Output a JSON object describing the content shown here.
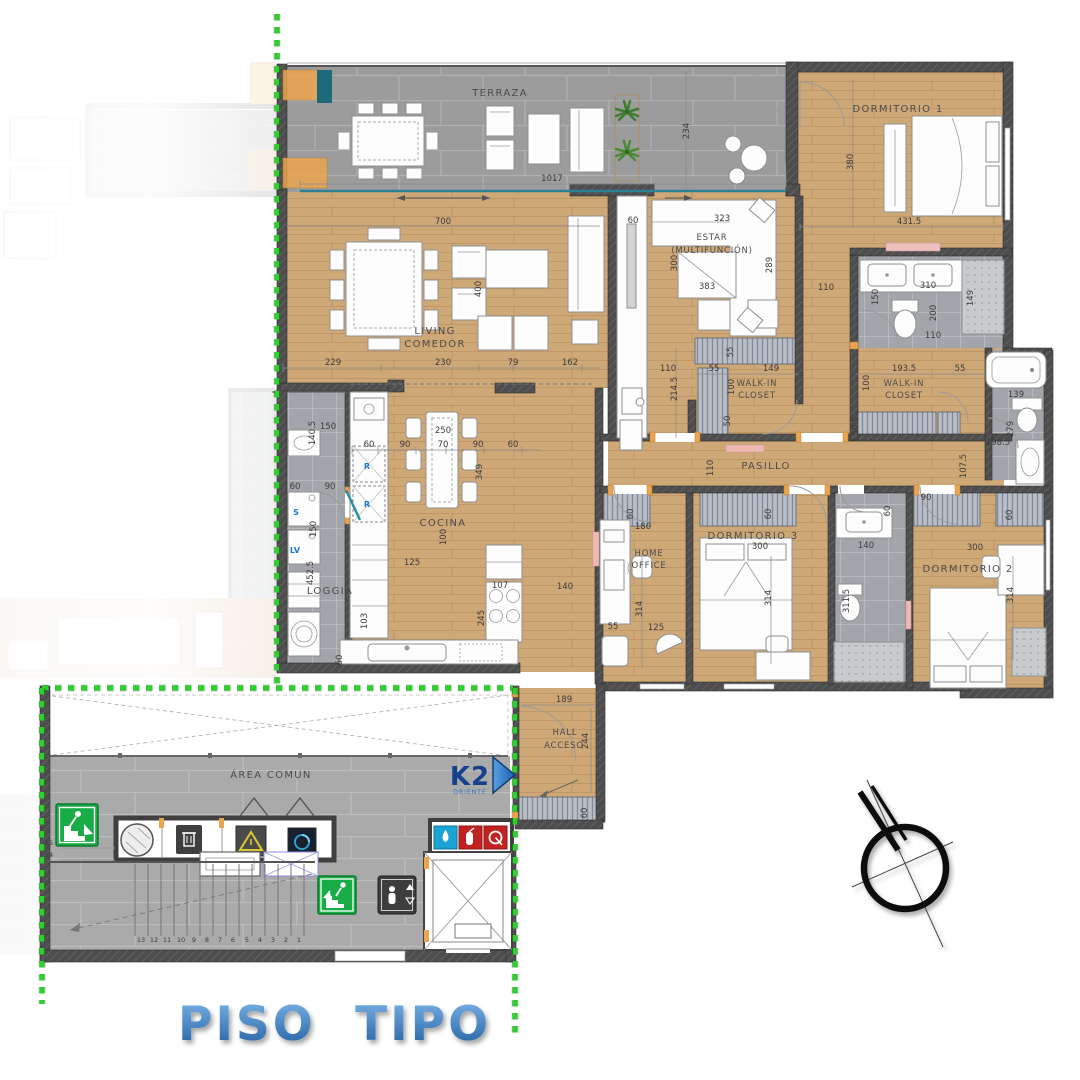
{
  "title": {
    "text": "PISO TIPO",
    "color_top": "#7db5e8",
    "color_bottom": "#1d5c9e"
  },
  "logo": {
    "name": "K2",
    "subtitle": "ORIENTE",
    "text_color": "#17418c",
    "arrow_color": "#2e86d6"
  },
  "rooms": {
    "terraza": "TERRAZA",
    "dormitorio1": "DORMITORIO 1",
    "living_l1": "LIVING",
    "living_l2": "COMEDOR",
    "estar_l1": "ESTAR",
    "estar_l2": "(MULTIFUNCIÓN)",
    "walkin_l1": "WALK-IN",
    "walkin_l2": "CLOSET",
    "pasillo": "PASILLO",
    "cocina": "COCINA",
    "loggia": "LOGGIA",
    "home_l1": "HOME",
    "home_l2": "OFFICE",
    "dormitorio3": "DORMITORIO 3",
    "dormitorio2": "DORMITORIO 2",
    "hall_l1": "HALL",
    "hall_l2": "ACCESO",
    "area_comun": "ÁREA COMUN"
  },
  "dims": {
    "terraza": [
      "1017",
      "234"
    ],
    "dormitorio1": [
      "380",
      "431.5"
    ],
    "living": [
      "700",
      "60",
      "400",
      "229",
      "230",
      "79",
      "162"
    ],
    "estar": [
      "323",
      "300",
      "383",
      "289",
      "110",
      "214.5"
    ],
    "bath1": [
      "110",
      "150",
      "310",
      "200",
      "110",
      "149"
    ],
    "walkin1": [
      "55",
      "55",
      "149",
      "100",
      "50"
    ],
    "walkin2": [
      "193.5",
      "55",
      "100",
      "50.5"
    ],
    "bath2": [
      "139",
      "279",
      "198.5",
      "107.5"
    ],
    "pasillo": [
      "110"
    ],
    "closets": [
      "60",
      "60",
      "60",
      "60",
      "90"
    ],
    "home_office": [
      "180",
      "314",
      "55",
      "125"
    ],
    "dormitorio3": [
      "300",
      "314"
    ],
    "bath3": [
      "140",
      "311.5"
    ],
    "dormitorio2": [
      "300",
      "314"
    ],
    "cocina": [
      "60",
      "90",
      "250",
      "70",
      "90",
      "60",
      "349",
      "100",
      "125",
      "103",
      "107",
      "245",
      "140"
    ],
    "loggia": [
      "140.5",
      "150",
      "60",
      "90",
      "150",
      "452.5",
      "60"
    ],
    "hall": [
      "189",
      "244",
      "60"
    ]
  },
  "appliances": {
    "cocina": [
      "R",
      "R"
    ],
    "loggia": [
      "S",
      "LV"
    ]
  },
  "stairs": {
    "upper": [
      "15",
      "14"
    ],
    "treads": [
      "13",
      "12",
      "11",
      "10",
      "9",
      "8",
      "7",
      "6",
      "5",
      "4",
      "3",
      "2",
      "1"
    ]
  },
  "colors": {
    "wood": "#cfa878",
    "terrace_tile": "#9c9c9c",
    "bath_tile": "#a2a6aa",
    "wall": "#4d4d4d",
    "accent_orange": "#eca54f",
    "boundary_green": "#2bd22b",
    "exit_green": "#18ac46",
    "safety_red": "#c32222",
    "safety_blue": "#1ba3d6"
  }
}
